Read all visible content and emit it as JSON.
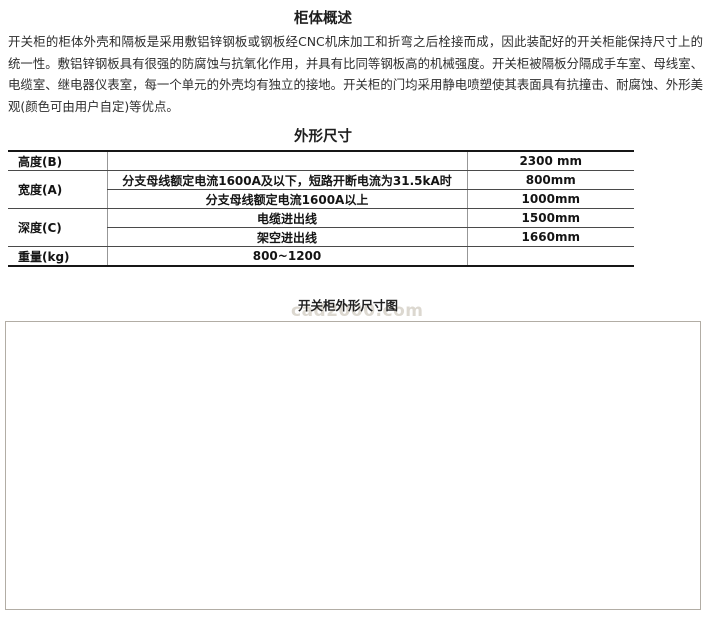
{
  "page": {
    "overview_title": "柜体概述",
    "overview_paragraph": "开关柜的柜体外壳和隔板是采用敷铝锌钢板或钢板经CNC机床加工和折弯之后栓接而成，因此装配好的开关柜能保持尺寸上的统一性。敷铝锌钢板具有很强的防腐蚀与抗氧化作用，并具有比同等钢板高的机械强度。开关柜被隔板分隔成手车室、母线室、电缆室、继电器仪表室，每一个单元的外壳均有独立的接地。开关柜的门均采用静电喷塑使其表面具有抗撞击、耐腐蚀、外形美观(颜色可由用户自定)等优点。",
    "dimensions_title": "外形尺寸",
    "diagram_caption": "开关柜外形尺寸图",
    "watermark": "cad2000.com"
  },
  "table": {
    "rows": [
      {
        "label": "高度(B)",
        "desc": "",
        "value": "2300 mm"
      },
      {
        "label": "宽度(A)",
        "desc": "分支母线额定电流1600A及以下，短路开断电流为31.5kA时",
        "value": "800mm"
      },
      {
        "desc": "分支母线额定电流1600A以上",
        "value": "1000mm"
      },
      {
        "label": "深度(C)",
        "desc": "电缆进出线",
        "value": "1500mm"
      },
      {
        "desc": "架空进出线",
        "value": "1660mm"
      },
      {
        "label": "重量(kg)",
        "desc": "800~1200",
        "value": ""
      }
    ]
  },
  "diagram": {
    "dim_a": "A",
    "dim_b": "B",
    "dim_c": "C"
  },
  "colors": {
    "table_outer_border": "#161616",
    "table_row_line": "#4a4a4a",
    "table_col_line": "#979797",
    "diagram_box_border": "#b2ada5",
    "drawing_line": "#4f4f4f",
    "watermark": "#dcd8d0",
    "text": "#2b2b2b"
  }
}
